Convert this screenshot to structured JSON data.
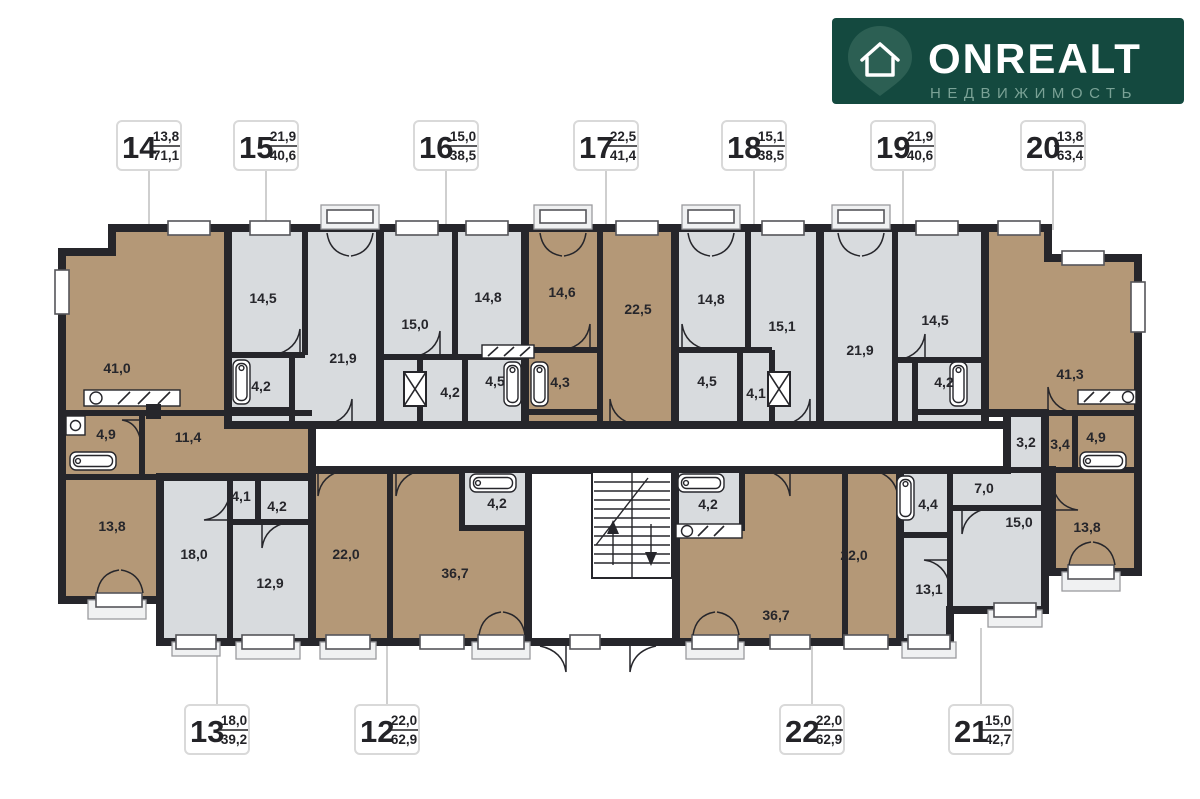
{
  "brand": {
    "name": "ONREALT",
    "subtitle": "НЕДВИЖИМОСТЬ"
  },
  "colors": {
    "wall": "#26262b",
    "room_warm": "#b49877",
    "room_cool": "#d8dbde",
    "logo_bg": "#14493f",
    "logo_subtitle": "#7aa296",
    "leader": "#cfcfcf"
  },
  "units": {
    "u14": {
      "num": "14",
      "upper": "13,8",
      "lower": "71,1"
    },
    "u15": {
      "num": "15",
      "upper": "21,9",
      "lower": "40,6"
    },
    "u16": {
      "num": "16",
      "upper": "15,0",
      "lower": "38,5"
    },
    "u17": {
      "num": "17",
      "upper": "22,5",
      "lower": "41,4"
    },
    "u18": {
      "num": "18",
      "upper": "15,1",
      "lower": "38,5"
    },
    "u19": {
      "num": "19",
      "upper": "21,9",
      "lower": "40,6"
    },
    "u20": {
      "num": "20",
      "upper": "13,8",
      "lower": "63,4"
    },
    "u13": {
      "num": "13",
      "upper": "18,0",
      "lower": "39,2"
    },
    "u12": {
      "num": "12",
      "upper": "22,0",
      "lower": "62,9"
    },
    "u22": {
      "num": "22",
      "upper": "22,0",
      "lower": "62,9"
    },
    "u21": {
      "num": "21",
      "upper": "15,0",
      "lower": "42,7"
    }
  },
  "rooms": {
    "a14_living": "41,0",
    "a14_bath": "4,9",
    "a14_hall": "11,4",
    "a14_bed": "13,8",
    "a15_bed": "14,5",
    "a15_bath": "4,2",
    "a15_living": "21,9",
    "a16_living": "15,0",
    "a16_bed": "14,8",
    "a16_hall": "4,2",
    "a16_bath": "4,5",
    "a17_bed": "14,6",
    "a17_bath": "4,3",
    "a17_living": "22,5",
    "a18_bed": "14,8",
    "a18_bath": "4,5",
    "a18_hall": "4,1",
    "a18_living": "15,1",
    "a19_living": "21,9",
    "a19_bed": "14,5",
    "a19_bath": "4,2",
    "a20_living": "41,3",
    "a20_h1": "3,2",
    "a20_h2": "3,4",
    "a20_bath": "4,9",
    "a20_bed": "13,8",
    "a13_living": "18,0",
    "a13_hall": "4,1",
    "a13_bath": "4,2",
    "a13_bed": "12,9",
    "a12_bed": "22,0",
    "a12_living": "36,7",
    "a12_bath": "4,2",
    "a22_bath": "4,2",
    "a22_living": "36,7",
    "a22_bed": "22,0",
    "a21_bath": "4,4",
    "a21_bed": "13,1",
    "a21_hall": "7,0",
    "a21_living": "15,0"
  }
}
